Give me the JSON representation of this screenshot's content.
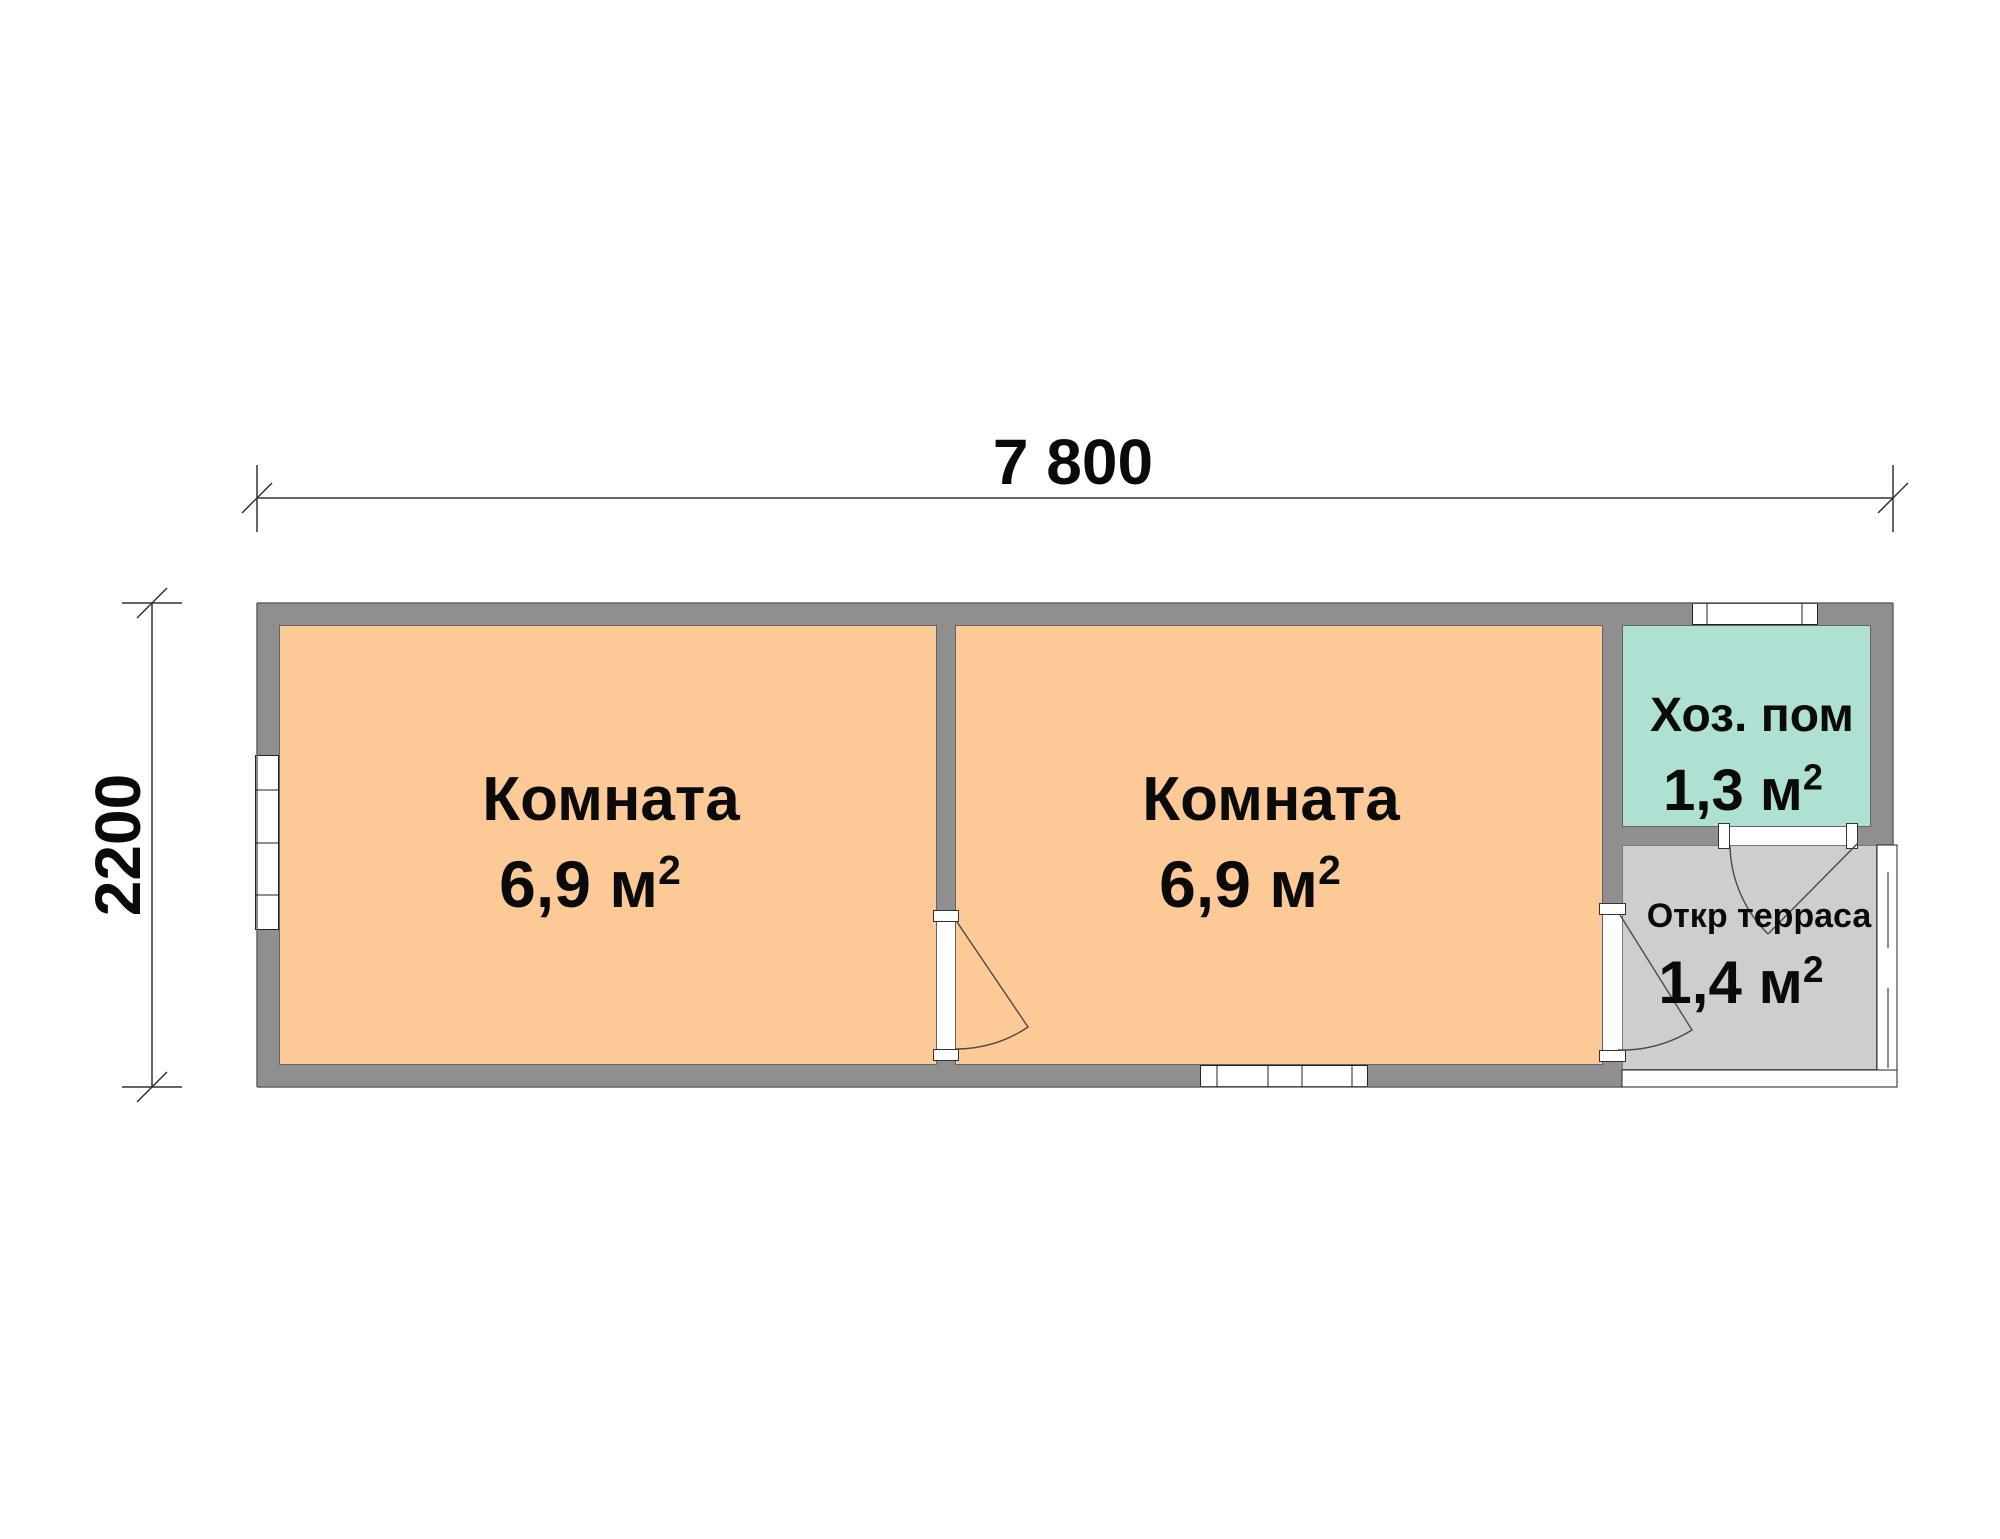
{
  "title": "floor-plan",
  "dimensions": {
    "width_label": "7 800",
    "height_label": "2200"
  },
  "rooms": [
    {
      "name": "Комната",
      "area": "6,9 м",
      "area_sup": "2",
      "fill": "#fdca97"
    },
    {
      "name": "Комната",
      "area": "6,9 м",
      "area_sup": "2",
      "fill": "#fdca97"
    },
    {
      "name": "Хоз. пом",
      "area": "1,3 м",
      "area_sup": "2",
      "fill": "#aee0d4"
    },
    {
      "name": "Откр терраса",
      "area": "1,4 м",
      "area_sup": "2",
      "fill": "#cecece"
    }
  ],
  "colors": {
    "wall": "#8f8f8f",
    "wall_edge": "#636363",
    "room_fill": "#fdca97",
    "utility_fill": "#aee0d4",
    "terrace_fill": "#cecece",
    "line": "#333333",
    "background": "#ffffff"
  }
}
